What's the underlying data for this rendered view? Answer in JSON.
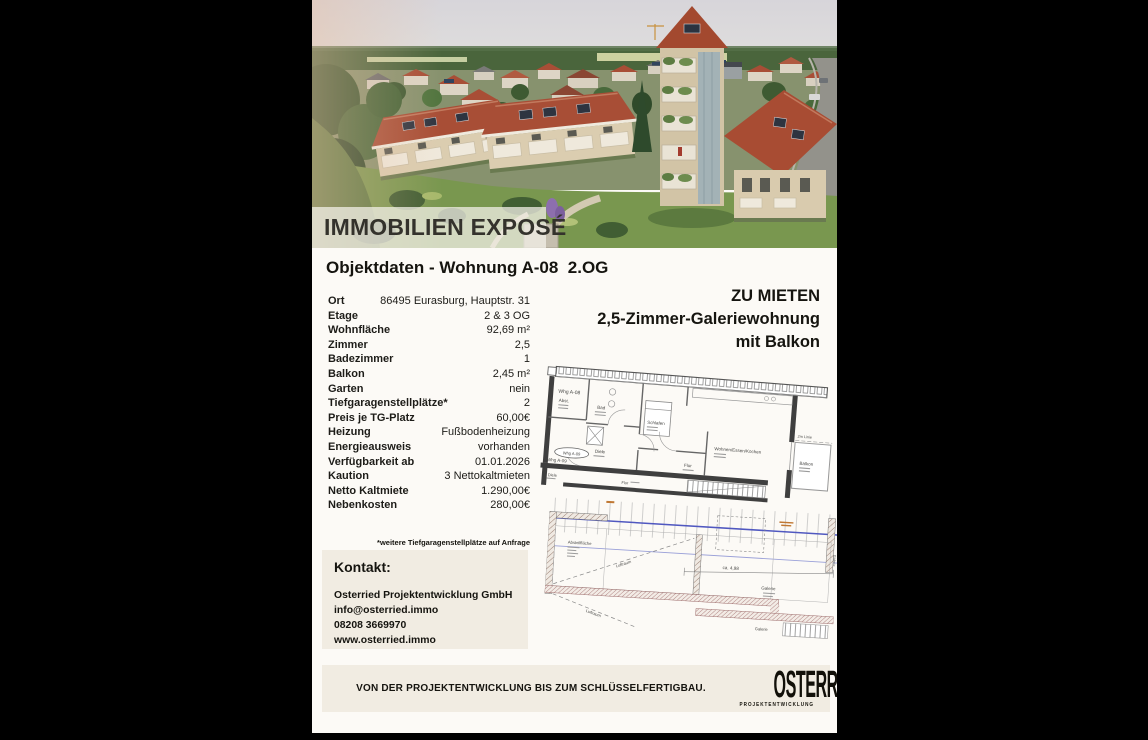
{
  "hero": {
    "banner": "IMMOBILIEN EXPOSÉ"
  },
  "objektdaten": {
    "heading": "Objektdaten - Wohnung A-08  2.OG",
    "rows": [
      {
        "label": "Ort",
        "value": "86495 Eurasburg, Hauptstr. 31"
      },
      {
        "label": "Etage",
        "value": "2 & 3 OG"
      },
      {
        "label": "Wohnfläche",
        "value": "92,69 m²"
      },
      {
        "label": "Zimmer",
        "value": "2,5"
      },
      {
        "label": "Badezimmer",
        "value": "1"
      },
      {
        "label": "Balkon",
        "value": "2,45 m²"
      },
      {
        "label": "Garten",
        "value": "nein"
      },
      {
        "label": "Tiefgaragenstellplätze*",
        "value": "2"
      },
      {
        "label": "Preis je TG-Platz",
        "value": "60,00€"
      },
      {
        "label": "Heizung",
        "value": "Fußbodenheizung"
      },
      {
        "label": "Energieausweis",
        "value": "vorhanden"
      },
      {
        "label": "Verfügbarkeit ab",
        "value": "01.01.2026"
      },
      {
        "label": "Kaution",
        "value": "3 Nettokaltmieten"
      },
      {
        "label": "Netto Kaltmiete",
        "value": "1.290,00€"
      },
      {
        "label": "Nebenkosten",
        "value": "280,00€"
      }
    ]
  },
  "offer": {
    "line1": "ZU MIETEN",
    "line2": "2,5-Zimmer-Galeriewohnung",
    "line3": "mit Balkon"
  },
  "footnote": "*weitere Tiefgaragenstellplätze auf Anfrage",
  "kontakt": {
    "heading": "Kontakt:",
    "company": "Osterried Projektentwicklung GmbH",
    "email": "info@osterried.immo",
    "phone": "08208 3669970",
    "web": "www.osterried.immo"
  },
  "footer": {
    "slogan": "VON DER PROJEKTENTWICKLUNG BIS ZUM SCHLÜSSELFERTIGBAU.",
    "logo": "OSTERRIED",
    "logo_sub": "PROJEKTENTWICKLUNG"
  },
  "plan1": {
    "unit": "Whg A-08",
    "rooms": {
      "abst": "Abst.",
      "bad": "Bad",
      "diele": "Diele",
      "schlafen": "Schlafen",
      "flur": "Flur",
      "wohnen": "Wohnen/Essen/Kochen",
      "balkon": "Balkon"
    },
    "neighbor": {
      "unit": "Whg A-09",
      "diele": "Diele",
      "flur": "Flur"
    },
    "dim": "2m Linie"
  },
  "plan2": {
    "abstell": "Abstellfläche",
    "luftraum": "Luftraum",
    "galerie": "Galerie",
    "dim": "ca. 4,98"
  },
  "colors": {
    "page_bg": "#fcfaf6",
    "panel_beige": "#f1ece2",
    "text_dark": "#15140f",
    "roof_red": "#a84e36",
    "plan_blue": "#5058c0",
    "plan_orange": "#c07833",
    "frame_black": "#000000"
  }
}
